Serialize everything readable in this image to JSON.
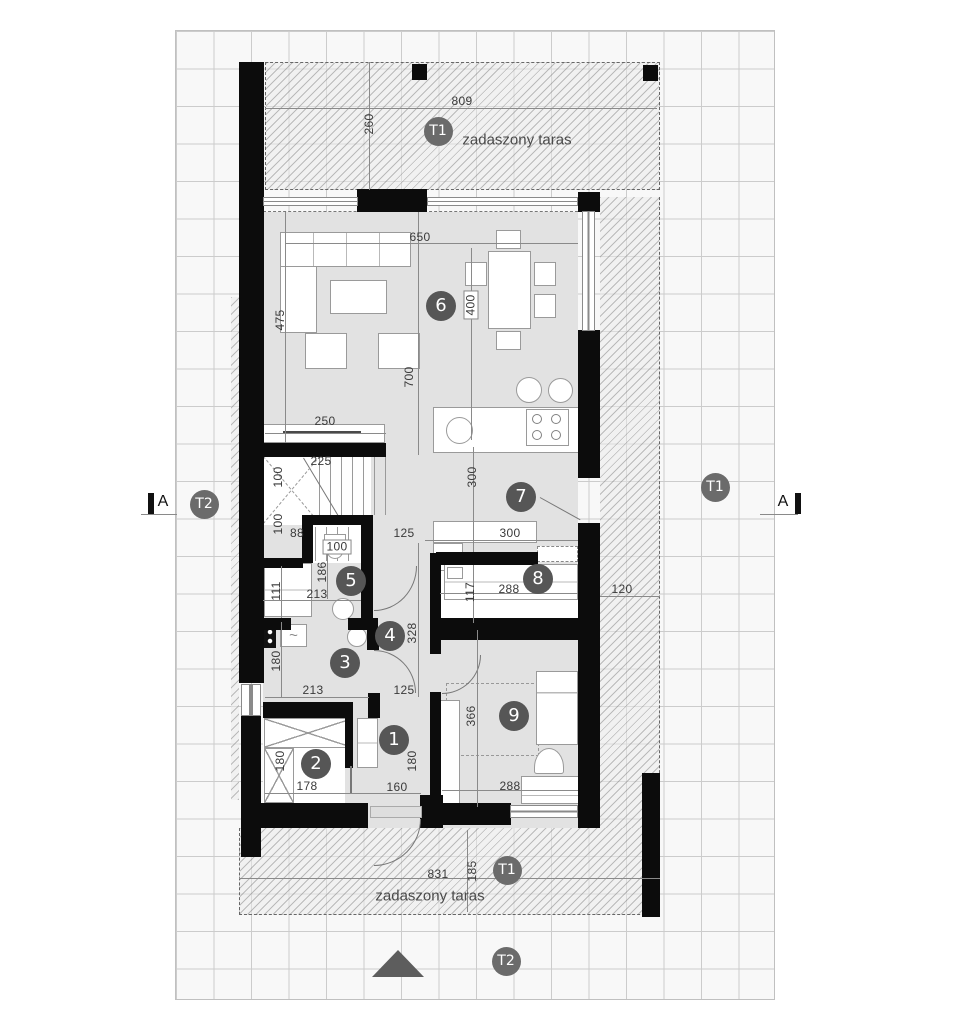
{
  "drawing": {
    "terrace_top": {
      "marker": "T1",
      "label": "zadaszony taras"
    },
    "terrace_bottom": {
      "marker": "T1",
      "label": "zadaszony taras"
    },
    "terrace_side_marker": "T1",
    "t2_markers": [
      "T2",
      "T2"
    ],
    "section_marker": "A",
    "rooms": [
      "1",
      "2",
      "3",
      "4",
      "5",
      "6",
      "7",
      "8",
      "9"
    ],
    "dims": [
      "809",
      "260",
      "650",
      "475",
      "400",
      "700",
      "250",
      "225",
      "100",
      "100",
      "88",
      "100",
      "125",
      "300",
      "300",
      "186",
      "213",
      "111",
      "328",
      "117",
      "288",
      "120",
      "180",
      "213",
      "125",
      "366",
      "180",
      "178",
      "160",
      "180",
      "288",
      "831",
      "185"
    ],
    "icons": {
      "boiler": "~"
    },
    "colors": {
      "wall": "#0c0c0c",
      "floor": "#e2e2e2",
      "badge": "#565656",
      "marker": "#6b6b6b"
    }
  }
}
